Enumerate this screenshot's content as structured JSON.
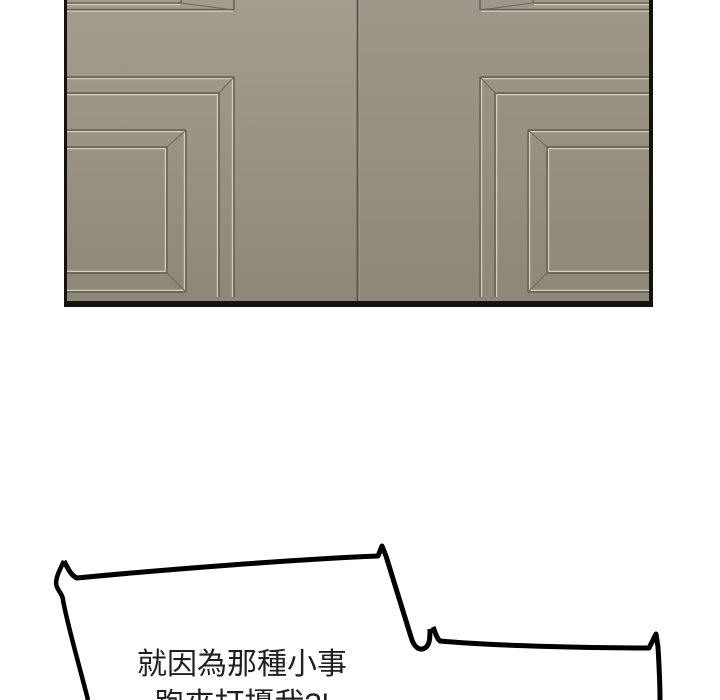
{
  "page": {
    "width": 720,
    "height": 700,
    "background": "#ffffff"
  },
  "artwork_panel": {
    "description": "closed grey-taupe double door with rectangular panel moldings, cropped top",
    "colors": {
      "door_top": "#a39d90",
      "door_bottom": "#8d877a",
      "molding_dark": "#645e51",
      "molding_light": "#dcd6c6",
      "seam": "#5c564a",
      "frame_border": "#141310"
    }
  },
  "speech_bubble": {
    "line1": "就因為那種小事",
    "line2": "跑來打擾我?!",
    "text_color": "#1f1f1f",
    "outline_color": "#000000",
    "fill_color": "#ffffff"
  }
}
